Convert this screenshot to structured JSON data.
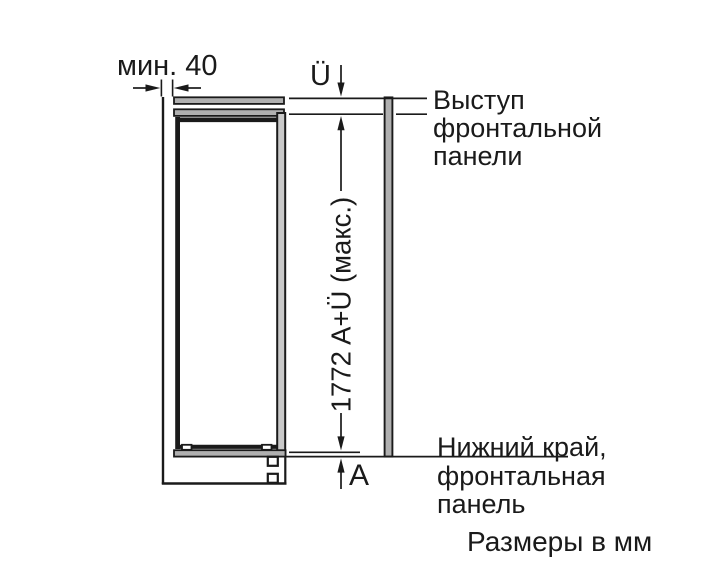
{
  "diagram_title": "appliance-niche-installation-dimensions",
  "labels": {
    "min_gap": "мин. 40",
    "overhang": "Ü",
    "height_max": "1772 A+Ü (макс.)",
    "bottom_gap": "A",
    "front_panel_protrusion": [
      "Выступ",
      "фронтальной",
      "панели"
    ],
    "bottom_edge_front_panel": [
      "Нижний край,",
      "фронтальная",
      "панель"
    ],
    "units_note": "Размеры в мм"
  },
  "colors": {
    "ink": "#1a1a1a",
    "panel_gray": "#b0b0b0",
    "frame_gray": "#c9c9c9",
    "background": "#ffffff"
  }
}
